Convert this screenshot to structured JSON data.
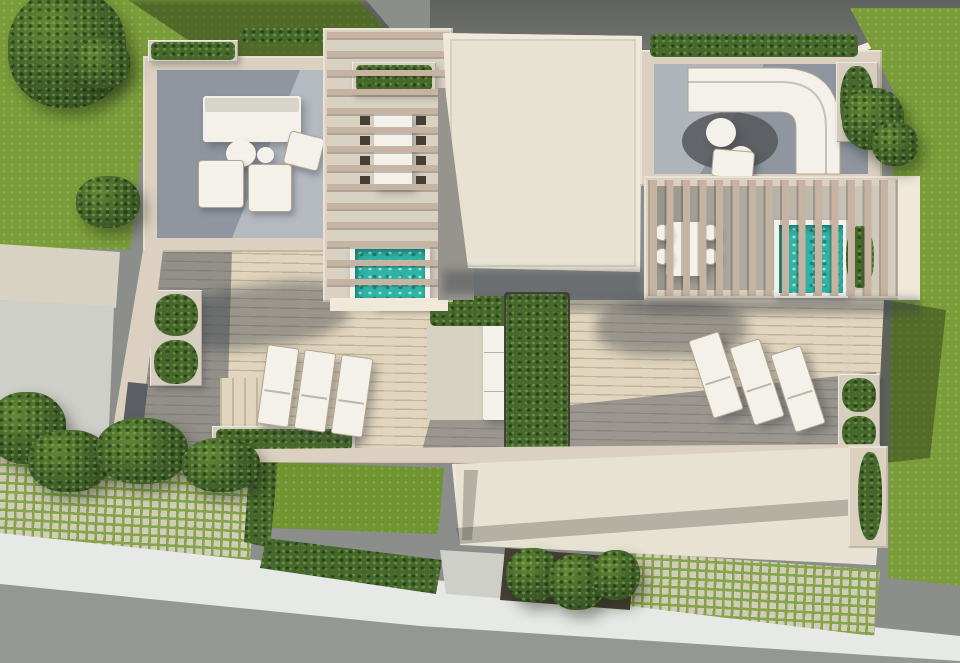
{
  "meta": {
    "type": "3d-architectural-render",
    "view": "top-down aerial",
    "subject": "Aerial top-down 3D render of a modern flat-roof villa with rooftop terraces, two pergolas, two turquoise plunge pools, white lounge furniture, six sun loungers, planters and hedges, lawns, grass-paver driveways, a sidewalk and a street"
  },
  "colors": {
    "grass": "#7b9d39",
    "lawn": "#6f9430",
    "grout": "#86a449",
    "paver": "#d2ccba",
    "pavement": "#8b8e8a",
    "road": "#949894",
    "sidewalk": "#e6e9e5",
    "cream": "#dcd1c0",
    "creamLight": "#f0e9da",
    "roof": "#e8e2d2",
    "stone": "#d8d2c3",
    "path": "#cecfc9",
    "terraceFloor": "#8f96a0",
    "terraceFloorLight": "#bcc0c5",
    "pergolaFloor": "#97948d",
    "deck": "#e1d5bd",
    "deckLine": "#c3b29a",
    "slat": "#c7b3a2",
    "white": "#f3f1e9",
    "taupe": "#b3a58d",
    "mauve": "#c8b1ad",
    "pool": "#2eb3a4",
    "poolSparkle": "#a9ece2",
    "rug": "#55585c",
    "hedge": "#47682d",
    "hedgeDark": "#324e1d",
    "tree": "#3f5d2a",
    "treeLight": "#628836",
    "planterBox": "#d8cec0",
    "planterDark": "#473f35",
    "shadowTint": "rgba(56,62,72,0.42)"
  },
  "scene": {
    "areas": [
      "neighbor-pavement-top",
      "lawn-left",
      "lawn-right-strip",
      "rooftop-lounge-terrace-northwest",
      "pergola-dining-north",
      "main-roof-slab",
      "lounge-terrace-northeast",
      "pergola-pool-east",
      "wood-deck-terrace-central",
      "lower-roof-slab-south",
      "front-garden-lawn",
      "grass-paver-driveway-west",
      "grass-paver-driveway-southeast",
      "sidewalk",
      "street"
    ],
    "objects": {
      "plunge_pools": 2,
      "sun_loungers": 6,
      "sofas": 2,
      "armchairs": 3,
      "outdoor_dining_sets": 2,
      "round_tables": 4,
      "planters_with_hedges": 12,
      "trees": 9
    }
  }
}
